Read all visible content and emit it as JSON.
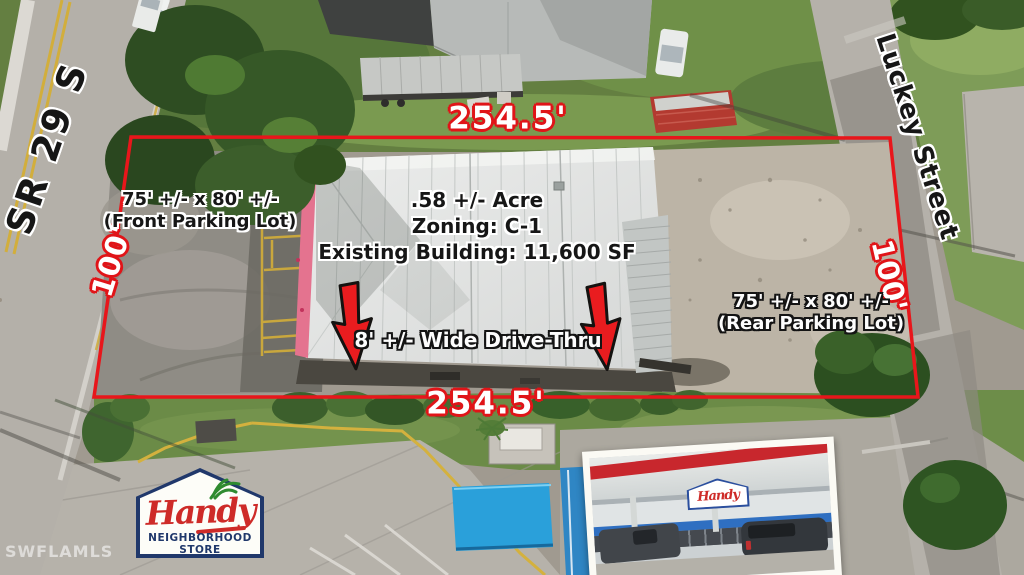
{
  "scene": {
    "description": "aerial drone photo of commercial property with boundary annotations"
  },
  "streets": {
    "left": "SR 29 S",
    "right": "Luckey Street"
  },
  "boundary": {
    "top": "254.5'",
    "bottom": "254.5'",
    "left": "100'",
    "right": "100'",
    "color": "#e8161b"
  },
  "labels": {
    "front_parking": {
      "line1": "75' +/- x 80' +/-",
      "line2": "(Front Parking Lot)"
    },
    "site_info": {
      "line1": ".58 +/- Acre",
      "line2": "Zoning: C-1",
      "line3": "Existing Building: 11,600 SF"
    },
    "drive_thru": "8' +/- Wide Drive-Thru",
    "rear_parking": {
      "line1": "75' +/- x 80' +/-",
      "line2": "(Rear Parking Lot)"
    }
  },
  "logo": {
    "brand": "Handy",
    "sub1": "NEIGHBORHOOD",
    "sub2": "STORE"
  },
  "inset": {
    "sign": "Handy"
  },
  "watermark": "SWFLAMLS",
  "colors": {
    "boundary_red": "#e8161b",
    "arrow_red": "#e91c1f",
    "logo_navy": "#20386b",
    "logo_red": "#ce2b28",
    "logo_green": "#2f8b30",
    "canopy_blue": "#2aa0da",
    "roof_pink": "#e4738f"
  }
}
